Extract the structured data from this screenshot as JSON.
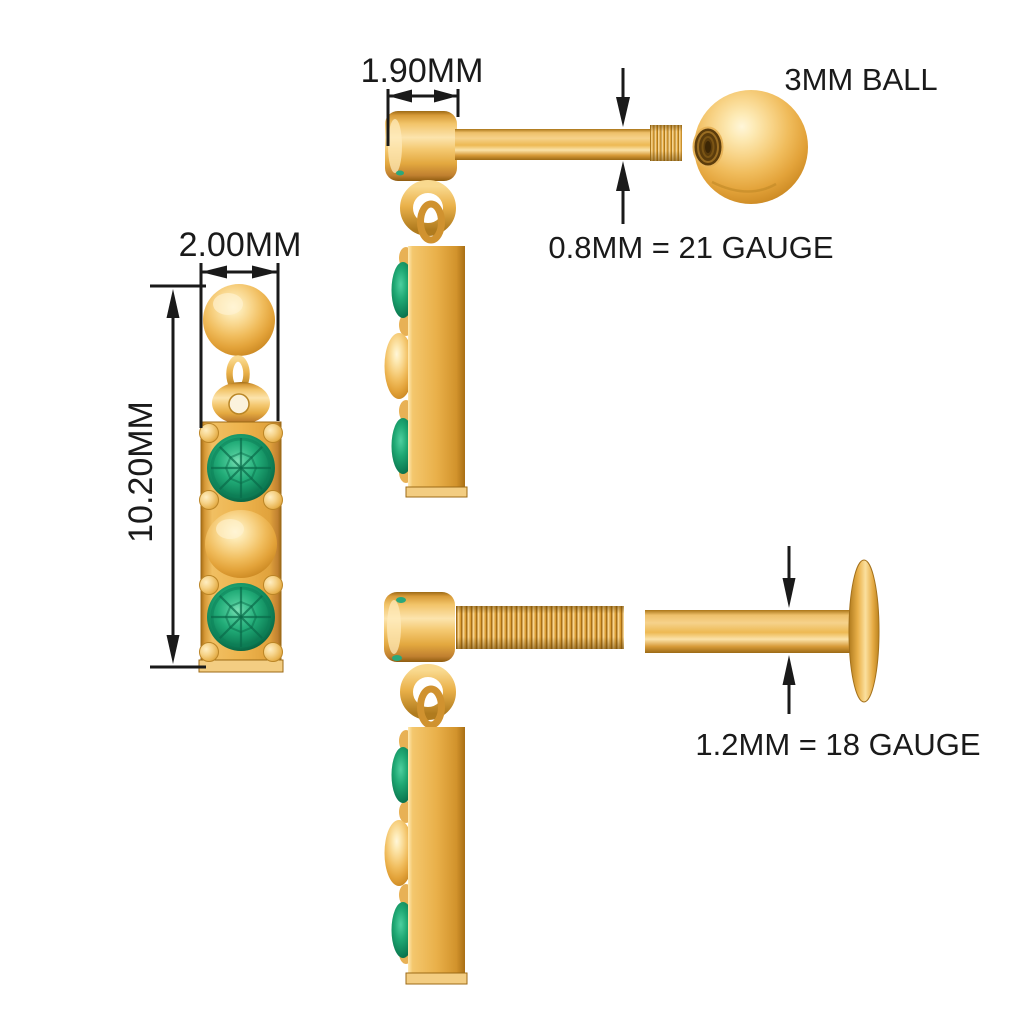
{
  "background": "#ffffff",
  "labels": {
    "head_width": "1.90MM",
    "ball": "3MM BALL",
    "gauge_21": "0.8MM = 21 GAUGE",
    "drop_width": "2.00MM",
    "drop_length": "10.20MM",
    "gauge_18": "1.2MM = 18 GAUGE"
  },
  "colors": {
    "background": "#ffffff",
    "gold_mid": "#eeb44e",
    "gold_highlight": "#ffe9b0",
    "gold_shadow": "#9c6a16",
    "emerald": "#21ab77",
    "emerald_dark": "#07573a",
    "dimension_lines": "#1a1a1a",
    "text": "#1a1a1a"
  }
}
